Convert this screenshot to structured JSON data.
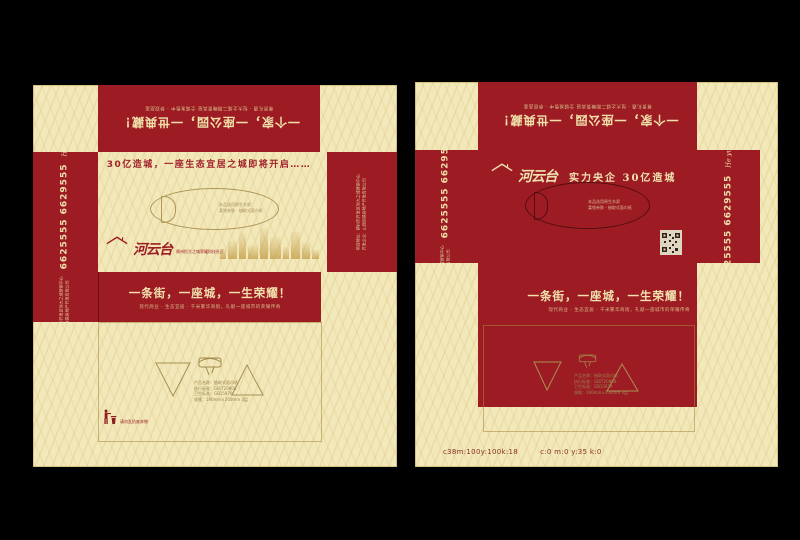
{
  "colors": {
    "background": "#000000",
    "cream": "#f2e8ba",
    "red": "#9d1c24",
    "gold": "#c8a55e"
  },
  "shared": {
    "top_small_line": "尊贵礼遇 · 恒大之城二期瞰景高层 全城发售中 · 恭迎品鉴",
    "top_title": "一个家，一座公园，一世典藏！",
    "street_title": "一条街，一座城，一生荣耀！",
    "street_subtitle": "现代商业 · 生态宜居 · 千米繁华商街，礼献一座城市的荣耀传奇",
    "logo_text": "河云台",
    "logo_script": "He yun tai",
    "phone": "6625555 6629555",
    "addr_line1": "项目地址：朔州市开发区恒大之城营销中心",
    "addr_line2": "开发企业：山西恒昌房地产开发有限公司",
    "oval_note_line1": "本品选用原生木浆",
    "oval_note_line2": "柔韧亲肤 · 抽取式面巾纸",
    "emblem_lines": [
      "产品名称：抽取式面巾纸",
      "执行标准：GB/T20808",
      "卫生标准：GB15979",
      "规格：190mm×200mm 3层"
    ],
    "trash_note": "请勿乱扔废弃物"
  },
  "left_panel": {
    "headline": "30亿造城，一座生态宜居之城即将开启……",
    "logo_sub": "朔州恒大之城荣耀科技社区"
  },
  "right_panel": {
    "headline": "实力央企  30亿造城",
    "cmyk_left": "c38m:100y:100k:18",
    "cmyk_right": "c:0 m:0 y:35 k:0"
  }
}
